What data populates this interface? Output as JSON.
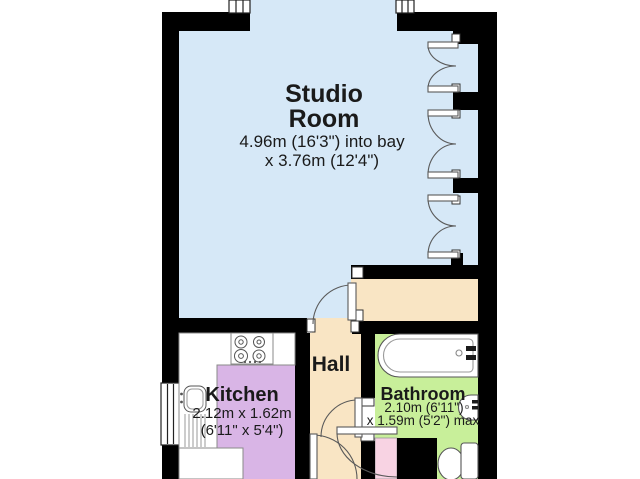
{
  "title": "Studio Flat Floor Plan",
  "colors": {
    "wall": "#000000",
    "line": "#5a5a5a",
    "counter_line": "#8a8a8a",
    "text": "#1a1a1a",
    "background": "#ffffff"
  },
  "rooms": {
    "studio": {
      "name_line1": "Studio",
      "name_line2": "Room",
      "dims_line1": "4.96m (16'3\") into bay",
      "dims_line2": "x 3.76m (12'4\")",
      "floor": "#d6e8f7"
    },
    "kitchen": {
      "name": "Kitchen",
      "dims_line1": "2.12m x 1.62m",
      "dims_line2": "(6'11\" x 5'4\")",
      "floor": "#d9b5e6"
    },
    "hall": {
      "name": "Hall",
      "floor": "#f9e5c4"
    },
    "bathroom": {
      "name": "Bathroom",
      "dims_line1": "2.10m (6'11\")",
      "dims_line2": "x 1.59m (5'2\") max",
      "floor": "#c8ef9a"
    },
    "closet": {
      "floor": "#f8d3e3"
    }
  }
}
